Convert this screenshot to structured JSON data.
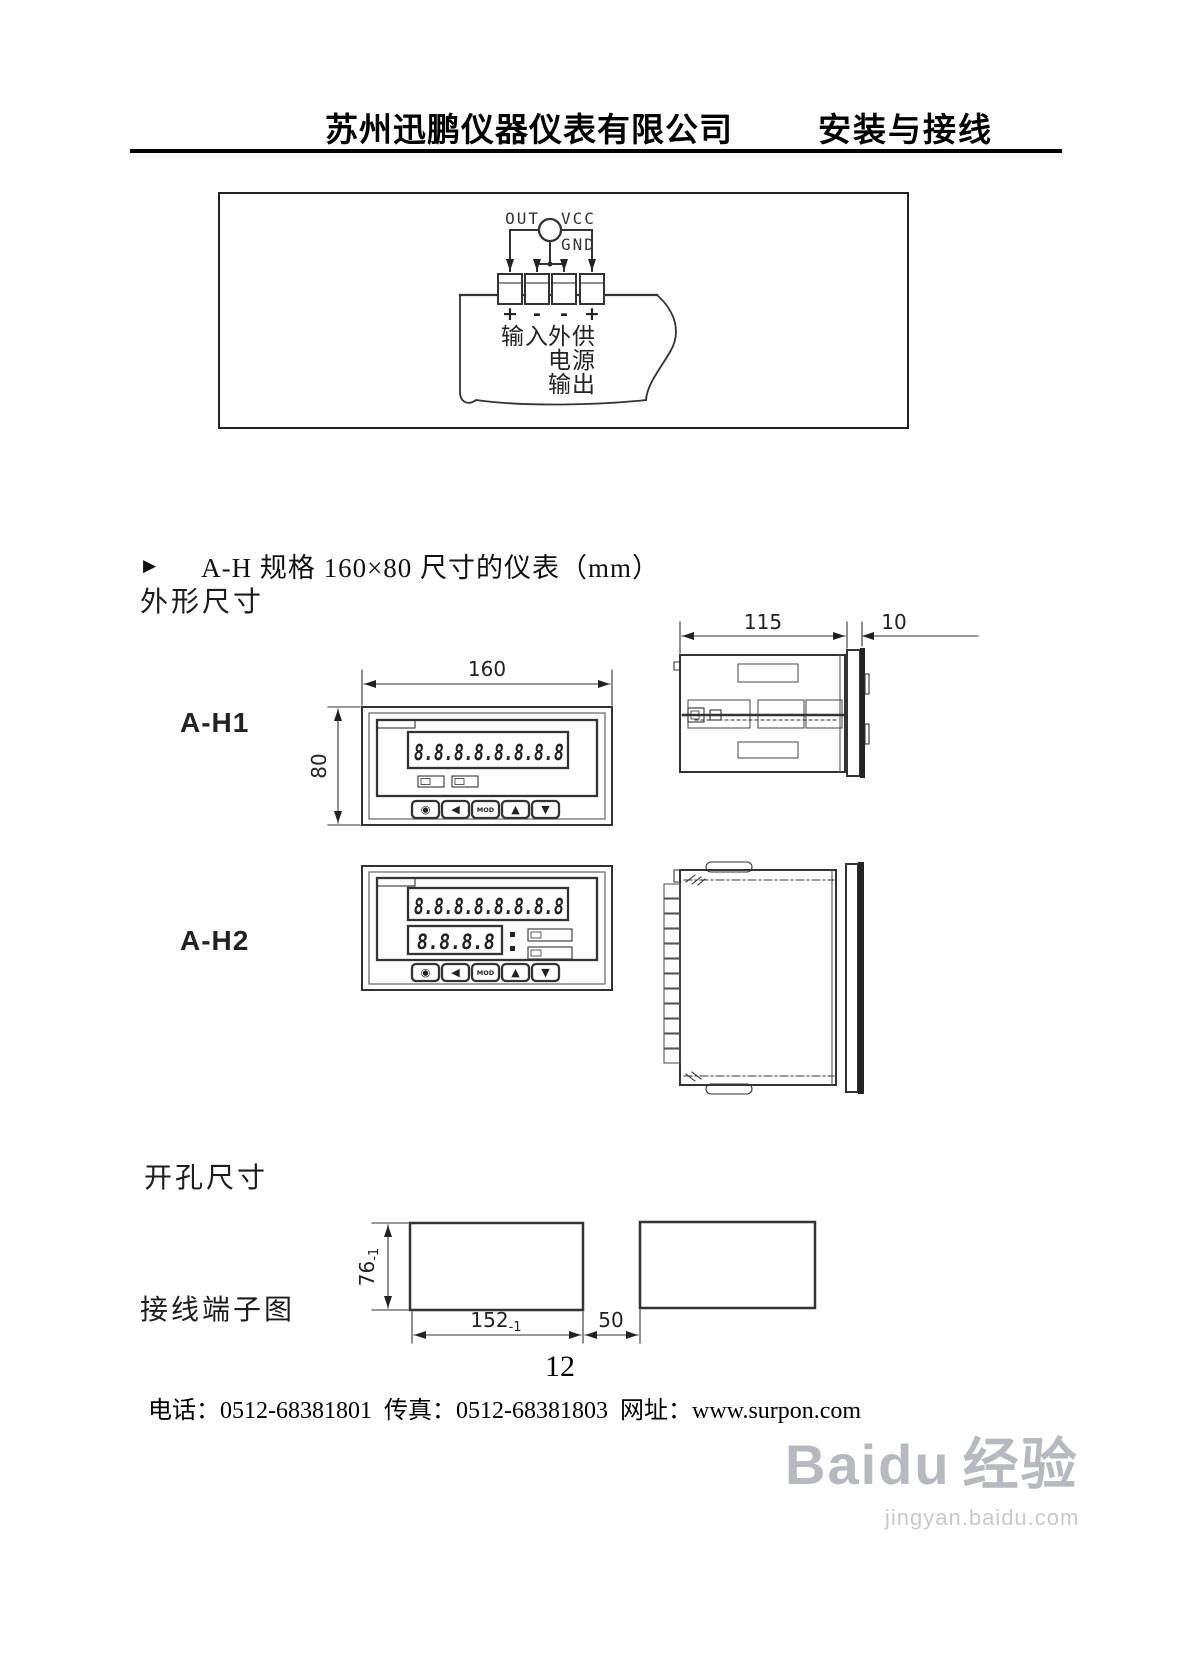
{
  "header": {
    "company": "苏州迅鹏仪器仪表有限公司",
    "section": "安装与接线"
  },
  "wiring": {
    "sensor_labels": {
      "out": "OUT",
      "vcc": "VCC",
      "gnd": "GND"
    },
    "polarity": [
      "+",
      "-",
      "-",
      "+"
    ],
    "input_label": "输入",
    "supply_label_rows": [
      "外供",
      "电源",
      "输出"
    ]
  },
  "spec_bullet": {
    "marker": "▶",
    "text": "A-H 规格 160×80 尺寸的仪表（mm）"
  },
  "outline": {
    "heading": "外形尺寸",
    "front_width": "160",
    "front_height": "80",
    "side_depth": "115",
    "side_bezel": "10",
    "models": [
      {
        "name": "A-H1"
      },
      {
        "name": "A-H2"
      }
    ],
    "display_digits_8": "8.8.8.8.8.8.8.8",
    "display_digits_4": "8.8.8.8",
    "button_glyphs": [
      "◉",
      "◀",
      "MOD",
      "▲",
      "▼"
    ]
  },
  "cutout": {
    "heading": "开孔尺寸",
    "height": "76",
    "height_tol": "-1",
    "width": "152",
    "width_tol": "-1",
    "gap": "50"
  },
  "terminals": {
    "heading": "接线端子图"
  },
  "footer": {
    "page_number": "12",
    "phone_label": "电话：",
    "phone": "0512-68381801",
    "fax_label": "传真：",
    "fax": "0512-68381803",
    "web_label": "网址：",
    "web": "www.surpon.com"
  },
  "watermark": {
    "brand": "Baidu",
    "suffix": "经验",
    "url": "jingyan.baidu.com"
  }
}
